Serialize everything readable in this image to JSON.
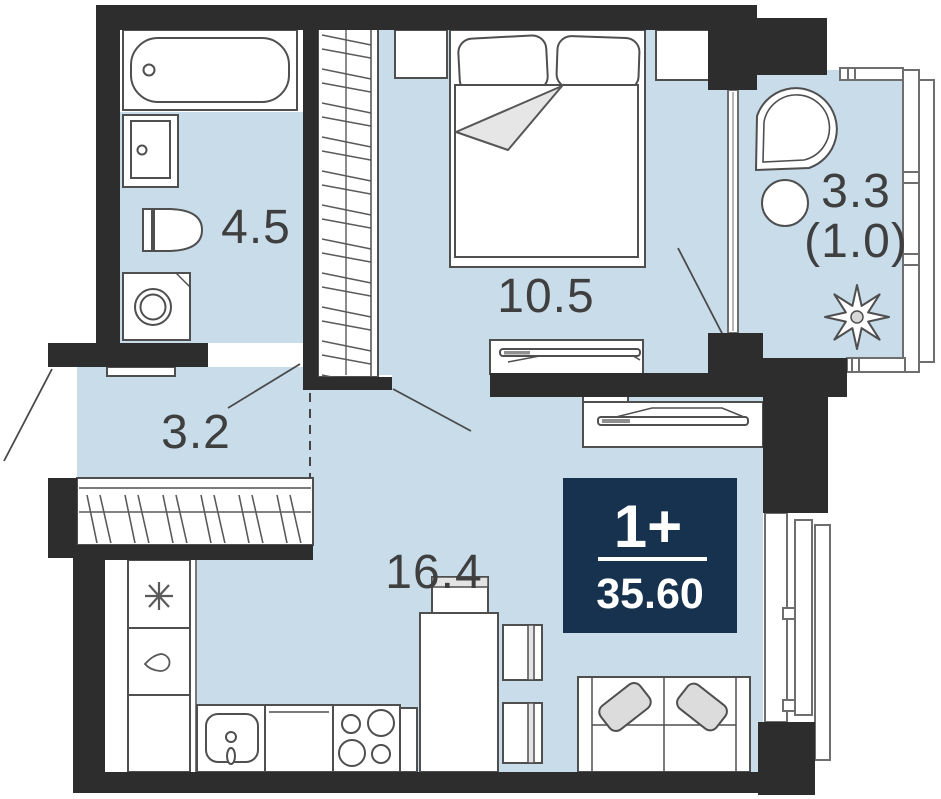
{
  "unit": {
    "type_label": "1+",
    "area_label": "35.60"
  },
  "rooms": {
    "bathroom": {
      "area": "4.5"
    },
    "hallway": {
      "area": "3.2"
    },
    "bedroom": {
      "area": "10.5"
    },
    "living_kitchen": {
      "area": "16.4"
    },
    "balcony": {
      "area": "3.3",
      "area_coeff": "(1.0)"
    }
  },
  "colors": {
    "floor": "#c8dcea",
    "wall": "#2d2d2d",
    "badge": "#16324f",
    "label": "#3f3f3f",
    "outline": "#4f4f4f"
  }
}
